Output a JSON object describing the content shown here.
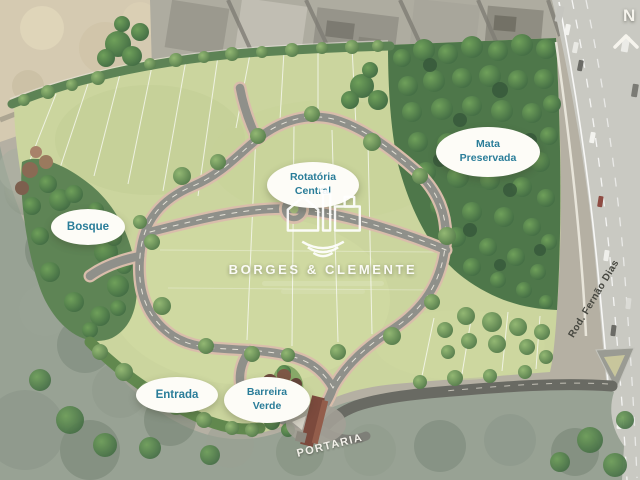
{
  "brand": {
    "name": "BORGES & CLEMENTE"
  },
  "compass": {
    "letter": "N"
  },
  "labels": {
    "bosque": "Bosque",
    "rotatoria": [
      "Rotatória",
      "Central"
    ],
    "mata": [
      "Mata",
      "Preservada"
    ],
    "entrada": "Entrada",
    "barreira": [
      "Barreira",
      "Verde"
    ],
    "portaria": "PORTARIA",
    "highway": "Rod. Fernão Dias"
  },
  "colors": {
    "label_text": "#2a7d99",
    "label_bg": "#fdfcf7",
    "lawn": "#cbd59e",
    "forest": "#4e774a",
    "road": "#8f908a",
    "sidewalk": "#d9bdab",
    "highway": "#c9c9c2",
    "scrub": "#98a294",
    "surroundings": "#b5b0a3",
    "access_road": "#696a63",
    "watermark": "#ffffff"
  }
}
